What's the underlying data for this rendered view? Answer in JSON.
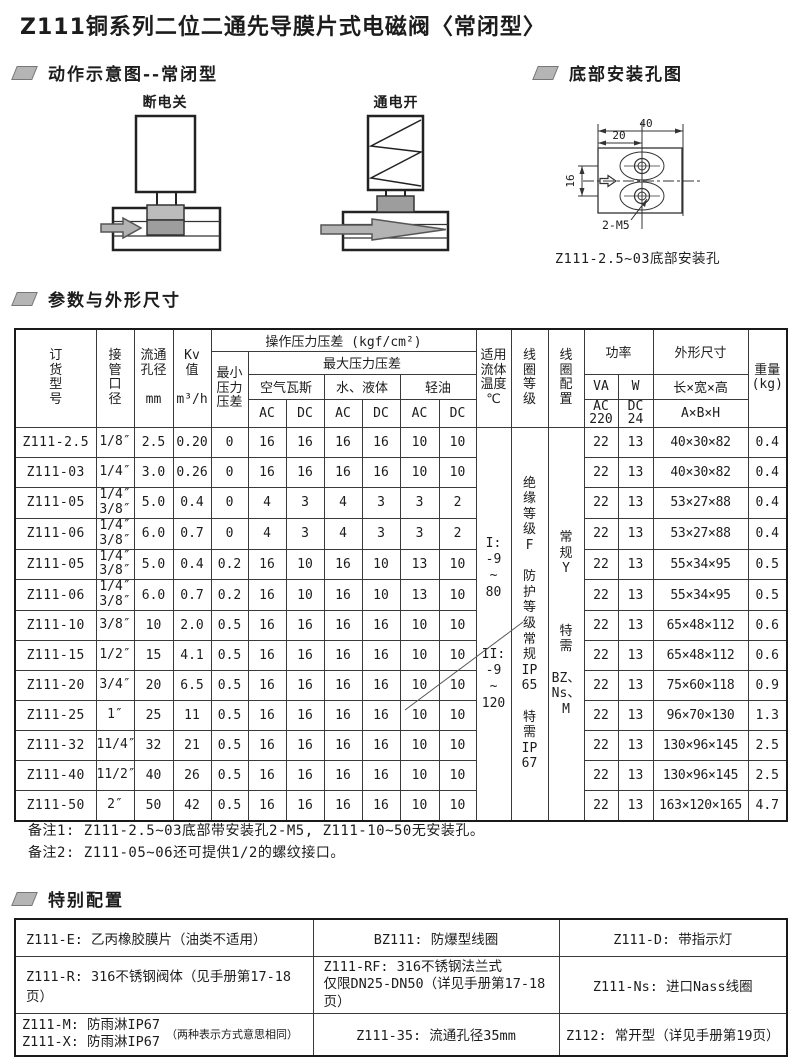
{
  "page_title": "Z111铜系列二位二通先导膜片式电磁阀〈常闭型〉",
  "sections": {
    "action": {
      "heading": "动作示意图--常闭型",
      "label_off": "断电关",
      "label_on": "通电开"
    },
    "mounting": {
      "heading": "底部安装孔图",
      "dim_total": "40",
      "dim_half": "20",
      "dim_side": "16",
      "thread": "2-M5",
      "caption": "Z111-2.5~03底部安装孔"
    },
    "params": {
      "heading": "参数与外形尺寸"
    },
    "special": {
      "heading": "特别配置"
    }
  },
  "table": {
    "headers": {
      "model": "订\n货\n型\n号",
      "port": "接\n管\n口\n径",
      "bore": "流通\n孔径\n\nmm",
      "kv": "Kv\n值\n\nm³/h",
      "op_dp": "操作压力压差 (kgf/cm²)",
      "min_dp": "最小\n压力\n压差",
      "max_dp": "最大压力压差",
      "air": "空气瓦斯",
      "water": "水、液体",
      "oil": "轻油",
      "ac": "AC",
      "dc": "DC",
      "temp": "适用\n流体\n温度\n℃",
      "coil_grade": "线\n圈\n等\n级",
      "coil_config": "线\n圈\n配\n置",
      "power": "功率",
      "va": "VA",
      "w": "W",
      "ac220": "AC\n220",
      "dc24": "DC\n24",
      "dims": "外形尺寸",
      "dims_formula": "长×宽×高",
      "dims_formula2": "A×B×H",
      "weight": "重量\n(kg)"
    },
    "merged": {
      "temp_range1": "I:\n-9\n~\n80",
      "temp_range2": "II:\n-9\n~\n120",
      "coil_grade": "绝\n缘\n等\n级\nF\n\n防\n护\n等\n级\n常\n规\nIP\n65\n\n特\n需\nIP\n67",
      "coil_config": "常\n规\nY\n\n\n\n特\n需\n\nBZ、\nNs、\nM"
    },
    "rows": [
      {
        "model": "Z111-2.5",
        "port": "1/8″",
        "bore": "2.5",
        "kv": "0.20",
        "min": "0",
        "a_ac": "16",
        "a_dc": "16",
        "w_ac": "16",
        "w_dc": "16",
        "o_ac": "10",
        "o_dc": "10",
        "va": "22",
        "w": "13",
        "dims": "40×30×82",
        "wt": "0.4"
      },
      {
        "model": "Z111-03",
        "port": "1/4″",
        "bore": "3.0",
        "kv": "0.26",
        "min": "0",
        "a_ac": "16",
        "a_dc": "16",
        "w_ac": "16",
        "w_dc": "16",
        "o_ac": "10",
        "o_dc": "10",
        "va": "22",
        "w": "13",
        "dims": "40×30×82",
        "wt": "0.4"
      },
      {
        "model": "Z111-05",
        "port": "1/4″\n3/8″",
        "bore": "5.0",
        "kv": "0.4",
        "min": "0",
        "a_ac": "4",
        "a_dc": "3",
        "w_ac": "4",
        "w_dc": "3",
        "o_ac": "3",
        "o_dc": "2",
        "va": "22",
        "w": "13",
        "dims": "53×27×88",
        "wt": "0.4"
      },
      {
        "model": "Z111-06",
        "port": "1/4″\n3/8″",
        "bore": "6.0",
        "kv": "0.7",
        "min": "0",
        "a_ac": "4",
        "a_dc": "3",
        "w_ac": "4",
        "w_dc": "3",
        "o_ac": "3",
        "o_dc": "2",
        "va": "22",
        "w": "13",
        "dims": "53×27×88",
        "wt": "0.4"
      },
      {
        "model": "Z111-05",
        "port": "1/4″\n3/8″",
        "bore": "5.0",
        "kv": "0.4",
        "min": "0.2",
        "a_ac": "16",
        "a_dc": "10",
        "w_ac": "16",
        "w_dc": "10",
        "o_ac": "13",
        "o_dc": "10",
        "va": "22",
        "w": "13",
        "dims": "55×34×95",
        "wt": "0.5"
      },
      {
        "model": "Z111-06",
        "port": "1/4″\n3/8″",
        "bore": "6.0",
        "kv": "0.7",
        "min": "0.2",
        "a_ac": "16",
        "a_dc": "10",
        "w_ac": "16",
        "w_dc": "10",
        "o_ac": "13",
        "o_dc": "10",
        "va": "22",
        "w": "13",
        "dims": "55×34×95",
        "wt": "0.5"
      },
      {
        "model": "Z111-10",
        "port": "3/8″",
        "bore": "10",
        "kv": "2.0",
        "min": "0.5",
        "a_ac": "16",
        "a_dc": "16",
        "w_ac": "16",
        "w_dc": "16",
        "o_ac": "10",
        "o_dc": "10",
        "va": "22",
        "w": "13",
        "dims": "65×48×112",
        "wt": "0.6"
      },
      {
        "model": "Z111-15",
        "port": "1/2″",
        "bore": "15",
        "kv": "4.1",
        "min": "0.5",
        "a_ac": "16",
        "a_dc": "16",
        "w_ac": "16",
        "w_dc": "16",
        "o_ac": "10",
        "o_dc": "10",
        "va": "22",
        "w": "13",
        "dims": "65×48×112",
        "wt": "0.6"
      },
      {
        "model": "Z111-20",
        "port": "3/4″",
        "bore": "20",
        "kv": "6.5",
        "min": "0.5",
        "a_ac": "16",
        "a_dc": "16",
        "w_ac": "16",
        "w_dc": "16",
        "o_ac": "10",
        "o_dc": "10",
        "va": "22",
        "w": "13",
        "dims": "75×60×118",
        "wt": "0.9"
      },
      {
        "model": "Z111-25",
        "port": "1″",
        "bore": "25",
        "kv": "11",
        "min": "0.5",
        "a_ac": "16",
        "a_dc": "16",
        "w_ac": "16",
        "w_dc": "16",
        "o_ac": "10",
        "o_dc": "10",
        "va": "22",
        "w": "13",
        "dims": "96×70×130",
        "wt": "1.3"
      },
      {
        "model": "Z111-32",
        "port": "11/4″",
        "bore": "32",
        "kv": "21",
        "min": "0.5",
        "a_ac": "16",
        "a_dc": "16",
        "w_ac": "16",
        "w_dc": "16",
        "o_ac": "10",
        "o_dc": "10",
        "va": "22",
        "w": "13",
        "dims": "130×96×145",
        "wt": "2.5"
      },
      {
        "model": "Z111-40",
        "port": "11/2″",
        "bore": "40",
        "kv": "26",
        "min": "0.5",
        "a_ac": "16",
        "a_dc": "16",
        "w_ac": "16",
        "w_dc": "16",
        "o_ac": "10",
        "o_dc": "10",
        "va": "22",
        "w": "13",
        "dims": "130×96×145",
        "wt": "2.5"
      },
      {
        "model": "Z111-50",
        "port": "2″",
        "bore": "50",
        "kv": "42",
        "min": "0.5",
        "a_ac": "16",
        "a_dc": "16",
        "w_ac": "16",
        "w_dc": "16",
        "o_ac": "10",
        "o_dc": "10",
        "va": "22",
        "w": "13",
        "dims": "163×120×165",
        "wt": "4.7"
      }
    ]
  },
  "notes": {
    "note1": "备注1: Z111-2.5~03底部带安装孔2-M5, Z111-10~50无安装孔。",
    "note2": "备注2: Z111-05~06还可提供1/2的螺纹接口。"
  },
  "special_table": {
    "rows": [
      {
        "c1": "Z111-E: 乙丙橡胶膜片（油类不适用）",
        "c2": "BZ111: 防爆型线圈",
        "c3": "Z111-D: 带指示灯"
      },
      {
        "c1": "Z111-R: 316不锈钢阀体（见手册第17-18页）",
        "c2": "Z111-RF: 316不锈钢法兰式\n仅限DN25-DN50（详见手册第17-18页）",
        "c3": "Z111-Ns: 进口Nass线圈"
      },
      {
        "c1": "Z111-M: 防雨淋IP67\nZ111-X: 防雨淋IP67",
        "c1_note": "（两种表示方式意思相同）",
        "c2": "Z111-35: 流通孔径35mm",
        "c3": "Z112: 常开型（详见手册第19页）"
      }
    ]
  }
}
